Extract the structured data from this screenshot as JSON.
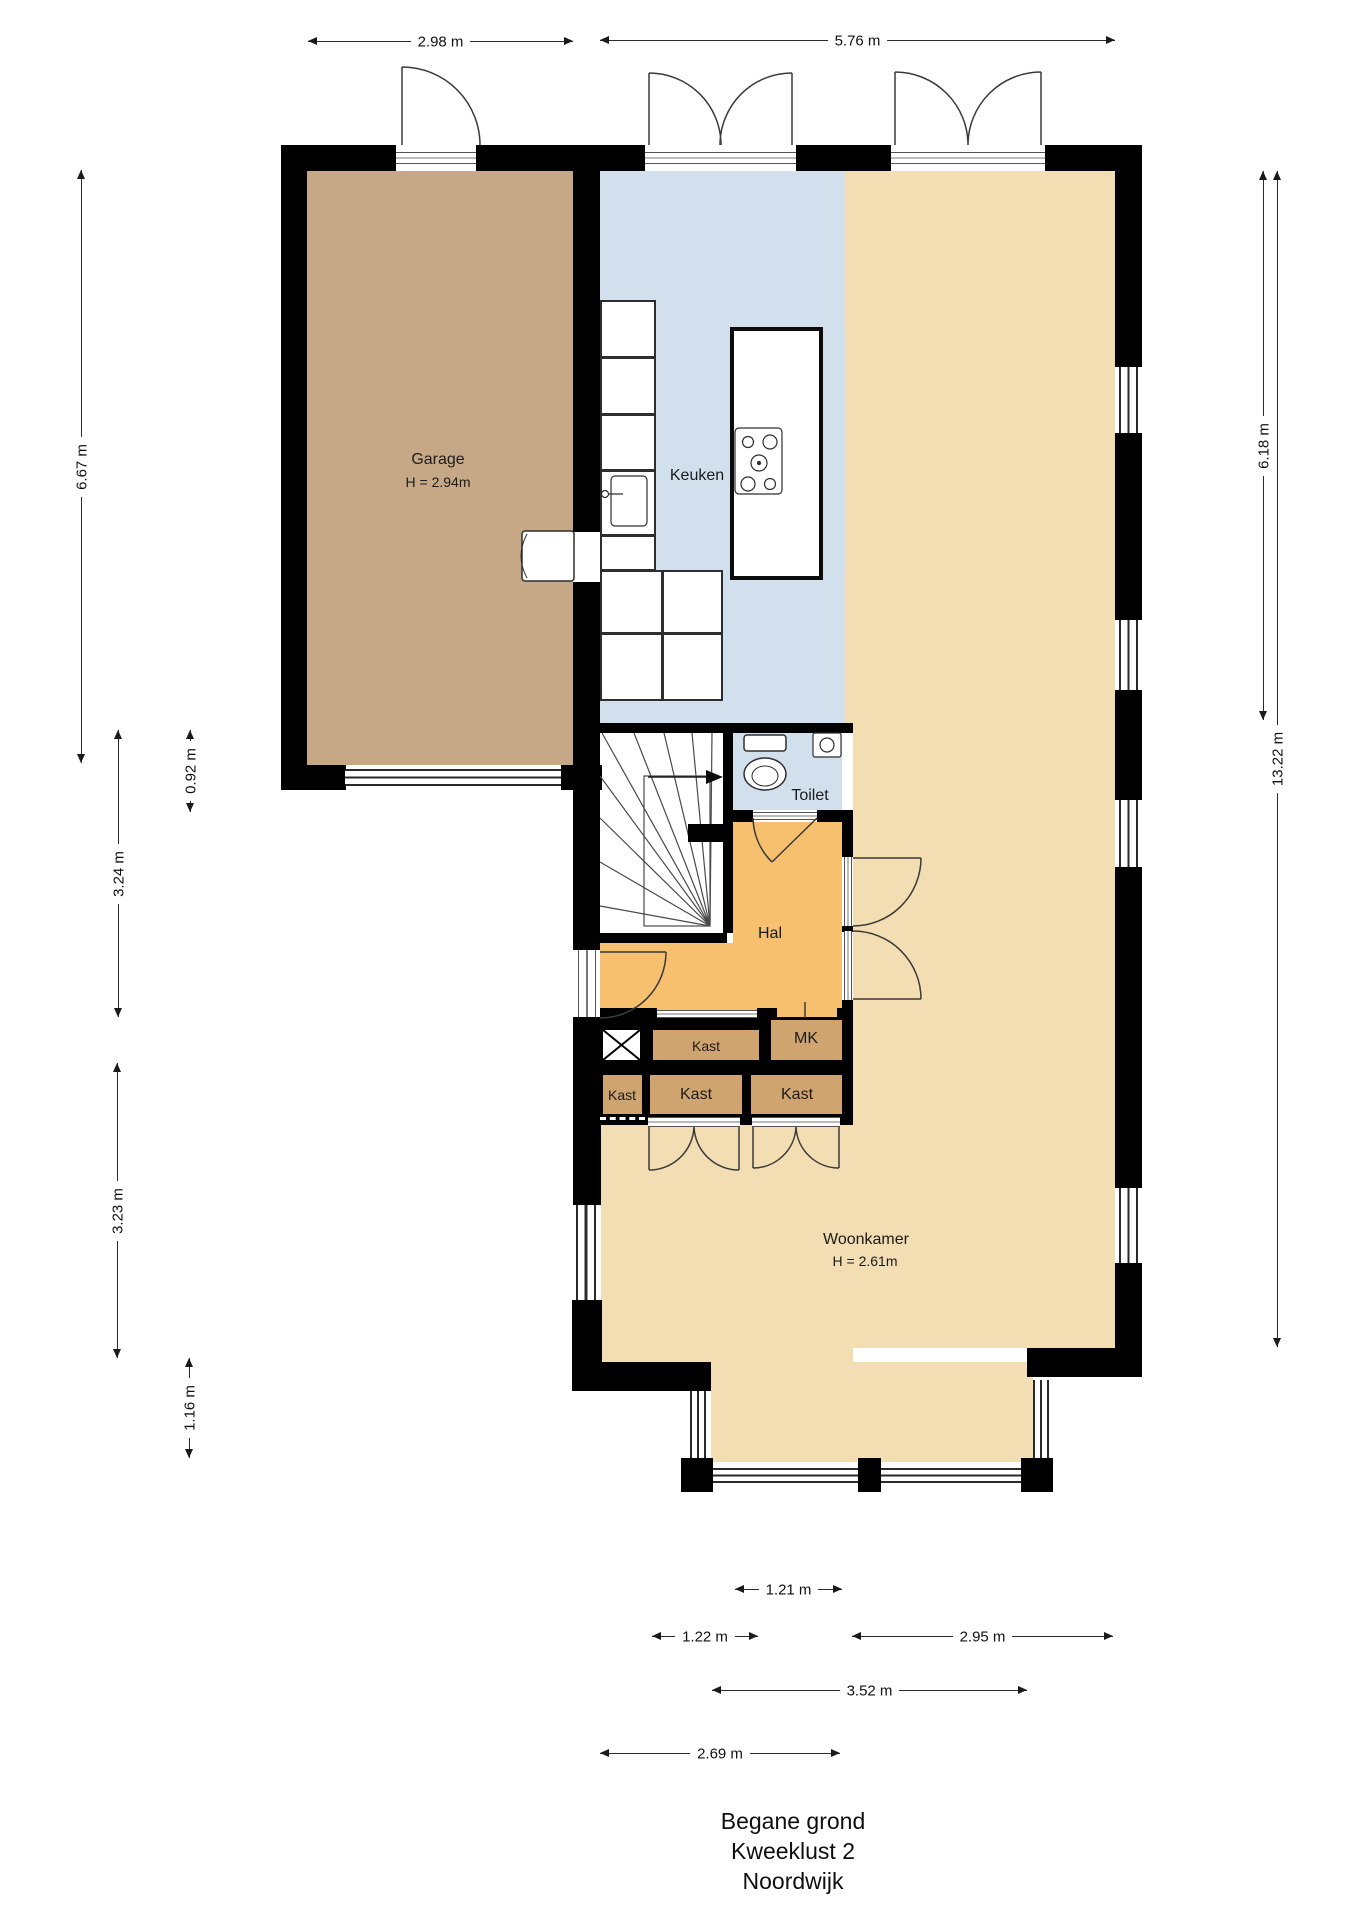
{
  "plan": {
    "floor_name": "Begane grond",
    "rooms": {
      "garage": {
        "label": "Garage",
        "height": "H = 2.94m"
      },
      "keuken": {
        "label": "Keuken"
      },
      "toilet": {
        "label": "Toilet"
      },
      "hal": {
        "label": "Hal"
      },
      "woonkamer": {
        "label": "Woonkamer",
        "height": "H = 2.61m"
      },
      "kast_top": {
        "label": "Kast"
      },
      "mk": {
        "label": "MK"
      },
      "kast_a": {
        "label": "Kast"
      },
      "kast_b": {
        "label": "Kast"
      },
      "kast_c": {
        "label": "Kast"
      }
    },
    "dimensions": {
      "top_left": "2.98 m",
      "top_right": "5.76 m",
      "left_garage": "6.67 m",
      "left_offset": "0.92 m",
      "left_hall": "3.24 m",
      "left_living": "3.23 m",
      "left_bay": "1.16 m",
      "right_upper": "6.18 m",
      "right_total": "13.22 m",
      "bottom_1": "1.21 m",
      "bottom_2": "1.22 m",
      "bottom_3": "2.95 m",
      "bottom_4": "3.52 m",
      "bottom_5": "2.69 m"
    }
  },
  "title": {
    "line1": "Begane grond",
    "line2": "Kweeklust 2",
    "line3": "Noordwijk"
  },
  "colors": {
    "garage_floor": "#c6a887",
    "kitchen_floor": "#d2e0ee",
    "toilet_floor": "#d2e0ee",
    "hall_floor": "#f7c06e",
    "living_floor": "#f3ddb2",
    "closet_fill": "#d0a46e",
    "wall": "#000000"
  }
}
